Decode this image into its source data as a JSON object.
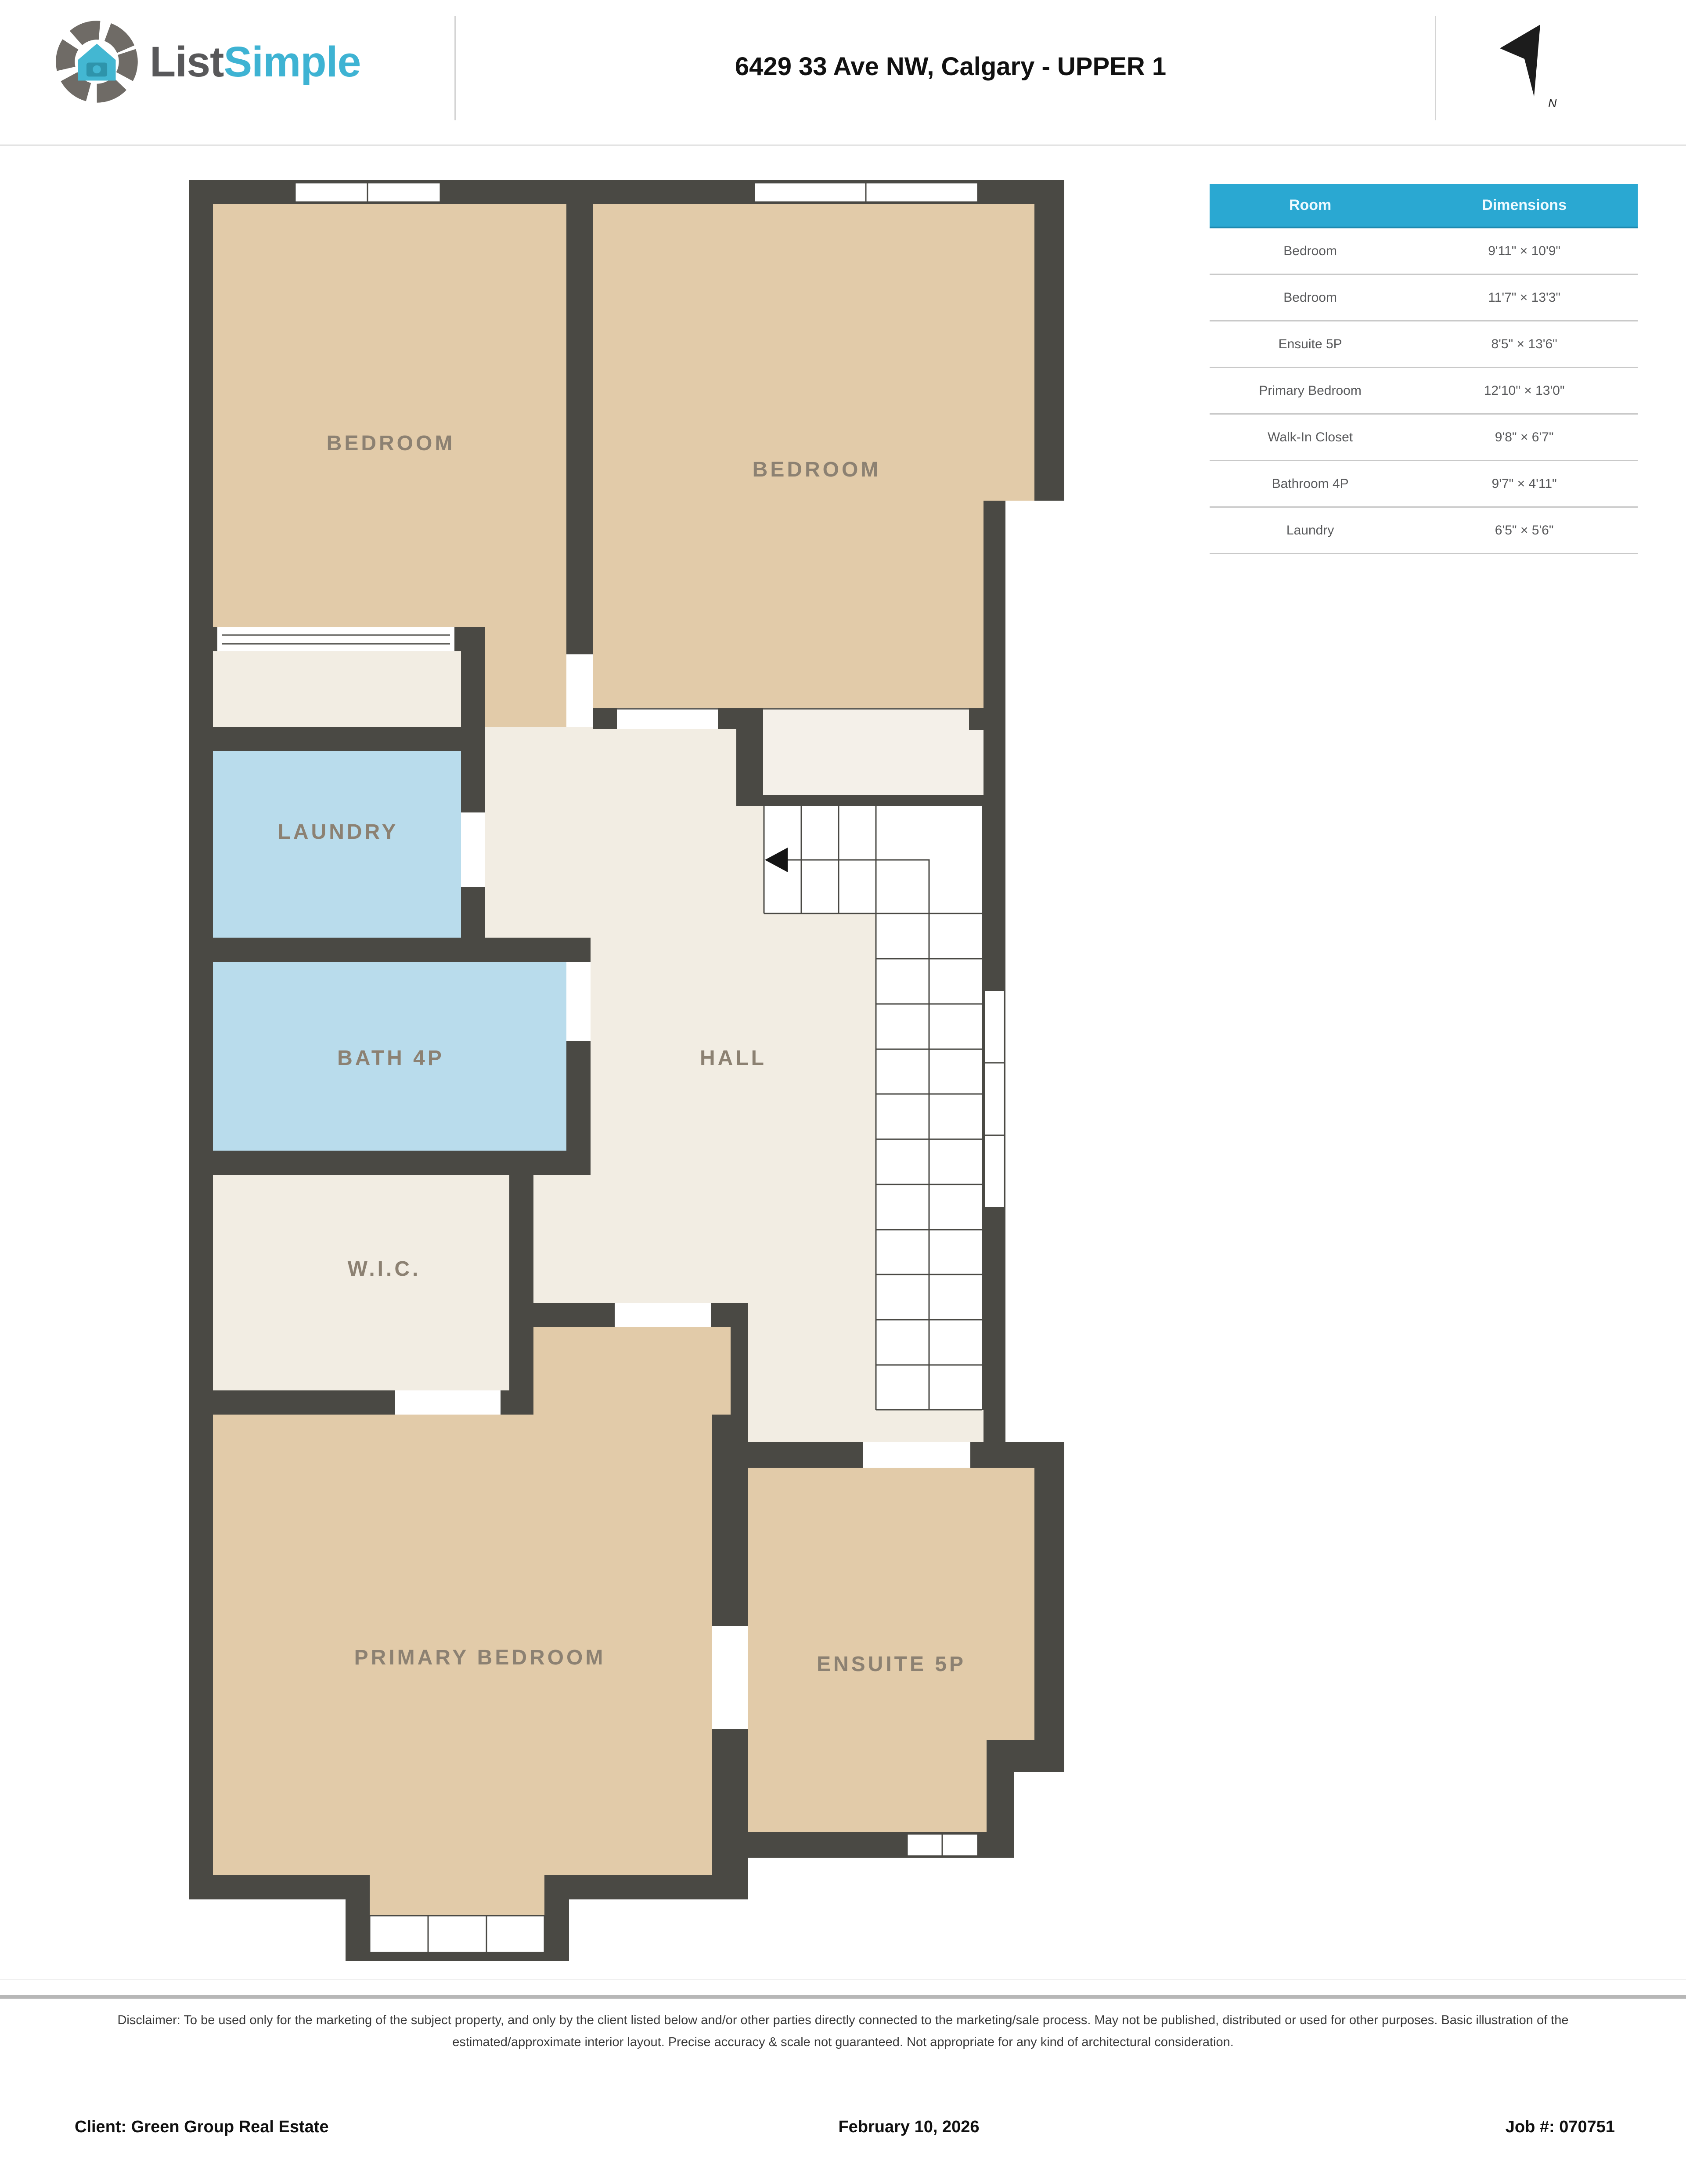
{
  "header": {
    "logo": {
      "word_dark": "List",
      "word_accent": "Simple"
    },
    "title": "6429 33 Ave NW, Calgary - UPPER 1",
    "north_arrow_label": "N"
  },
  "room_table": {
    "columns": [
      "Room",
      "Dimensions"
    ],
    "rows": [
      {
        "room": "Bedroom",
        "dimensions": "9'11\" × 10'9\""
      },
      {
        "room": "Bedroom",
        "dimensions": "11'7\" × 13'3\""
      },
      {
        "room": "Ensuite 5P",
        "dimensions": "8'5\" × 13'6\""
      },
      {
        "room": "Primary Bedroom",
        "dimensions": "12'10\" × 13'0\""
      },
      {
        "room": "Walk-In Closet",
        "dimensions": "9'8\" × 6'7\""
      },
      {
        "room": "Bathroom 4P",
        "dimensions": "9'7\" × 4'11\""
      },
      {
        "room": "Laundry",
        "dimensions": "6'5\" × 5'6\""
      }
    ]
  },
  "floor_plan": {
    "labels": {
      "bedroom_left": "BEDROOM",
      "bedroom_right": "BEDROOM",
      "laundry": "LAUNDRY",
      "bath": "BATH 4P",
      "hall": "HALL",
      "wic": "W.I.C.",
      "primary": "PRIMARY BEDROOM",
      "ensuite": "ENSUITE 5P"
    },
    "colors": {
      "wall": "#4a4944",
      "bedroom_fill": "#e2cba9",
      "wet_room_fill": "#b9dcec",
      "hall_fill": "#f2ede3",
      "label_text": "#8c8172",
      "table_accent": "#2aa8d2",
      "logo_accent": "#3eb3d3"
    }
  },
  "disclaimer": "Disclaimer: To be used only for the marketing of the subject property, and only by the client listed below and/or other parties directly connected to the marketing/sale process. May not be published, distributed or used for other purposes. Basic illustration of the estimated/approximate interior layout. Precise accuracy & scale not guaranteed. Not appropriate for any kind of architectural consideration.",
  "footer": {
    "client": "Client: Green Group Real Estate",
    "date": "February 10, 2026",
    "job": "Job #: 070751"
  }
}
